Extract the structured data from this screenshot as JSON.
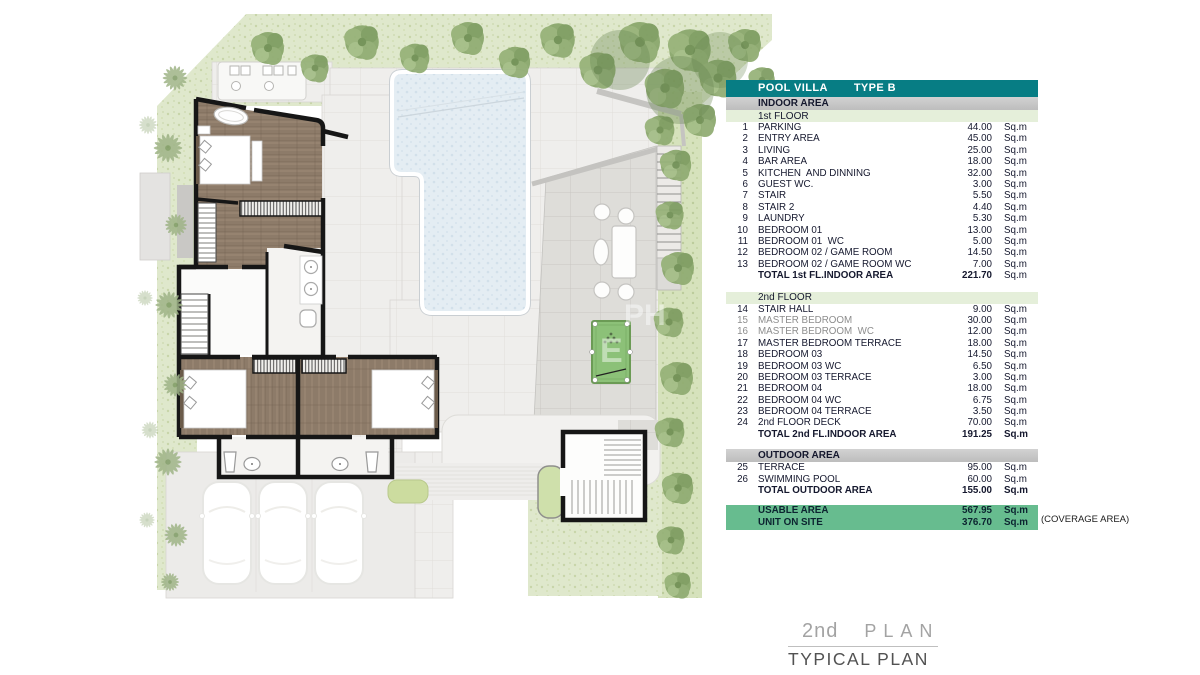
{
  "colors": {
    "table_header_teal": "#077d84",
    "section_bar_gray": "#c6c6c6",
    "floor_bar_green": "#e5efda",
    "summary_green": "#67bc8f",
    "pool_water": "#e4edf3",
    "grass": "#dfe8cc",
    "wood_floor": "#8d7b69",
    "wall_black": "#161616"
  },
  "plan": {
    "watermark_line1": "PH",
    "watermark_line2": "E"
  },
  "table": {
    "title_left": "POOL VILLA",
    "title_right": "TYPE B",
    "unit": "Sq.m",
    "sections": [
      {
        "bar": "gray",
        "label": "INDOOR AREA"
      },
      {
        "bar": "green",
        "label": "1st FLOOR"
      },
      {
        "rows": [
          [
            1,
            "PARKING",
            "44.00"
          ],
          [
            2,
            "ENTRY AREA",
            "45.00"
          ],
          [
            3,
            "LIVING",
            "25.00"
          ],
          [
            4,
            "BAR AREA",
            "18.00"
          ],
          [
            5,
            "KITCHEN  AND DINNING",
            "32.00"
          ],
          [
            6,
            "GUEST WC.",
            "3.00"
          ],
          [
            7,
            "STAIR",
            "5.50"
          ],
          [
            8,
            "STAIR 2",
            "4.40"
          ],
          [
            9,
            "LAUNDRY",
            "5.30"
          ],
          [
            10,
            "BEDROOM 01",
            "13.00"
          ],
          [
            11,
            "BEDROOM 01  WC",
            "5.00"
          ],
          [
            12,
            "BEDROOM 02 / GAME ROOM",
            "14.50"
          ],
          [
            13,
            "BEDROOM 02 / GAME ROOM WC",
            "7.00"
          ]
        ],
        "total": [
          "TOTAL 1st FL.INDOOR AREA",
          "221.70"
        ],
        "total_bold_unit": false,
        "gap_after": 9
      },
      {
        "bar": "green",
        "label": "2nd FLOOR"
      },
      {
        "rows": [
          [
            14,
            "STAIR HALL",
            "9.00"
          ],
          [
            15,
            "MASTER BEDROOM",
            "30.00"
          ],
          [
            16,
            "MASTER BEDROOM  WC",
            "12.00"
          ],
          [
            17,
            "MASTER BEDROOM TERRACE",
            "18.00"
          ],
          [
            18,
            "BEDROOM 03",
            "14.50"
          ],
          [
            19,
            "BEDROOM 03 WC",
            "6.50"
          ],
          [
            20,
            "BEDROOM 03 TERRACE",
            "3.00"
          ],
          [
            21,
            "BEDROOM 04",
            "18.00"
          ],
          [
            22,
            "BEDROOM 04 WC",
            "6.75"
          ],
          [
            23,
            "BEDROOM 04 TERRACE",
            "3.50"
          ],
          [
            24,
            "2nd FLOOR DECK",
            "70.00"
          ]
        ],
        "faded_nos": [
          15,
          16
        ],
        "total": [
          "TOTAL 2nd FL.INDOOR AREA",
          "191.25"
        ],
        "total_bold_unit": true,
        "gap_after": 8
      },
      {
        "bar": "gray",
        "label": "OUTDOOR AREA"
      },
      {
        "rows": [
          [
            25,
            "TERRACE",
            "95.00"
          ],
          [
            26,
            "SWIMMING POOL",
            "60.00"
          ]
        ],
        "total": [
          "TOTAL OUTDOOR AREA",
          "155.00"
        ],
        "total_bold_unit": true,
        "gap_after": 7
      }
    ],
    "summary": {
      "rows": [
        [
          "USABLE AREA",
          "567.95"
        ],
        [
          "UNIT ON SITE",
          "376.70"
        ]
      ],
      "note": "(COVERAGE AREA)"
    }
  },
  "footer": {
    "floor_label": "2nd",
    "plan_label": "PLAN",
    "subtitle": "TYPICAL PLAN"
  }
}
